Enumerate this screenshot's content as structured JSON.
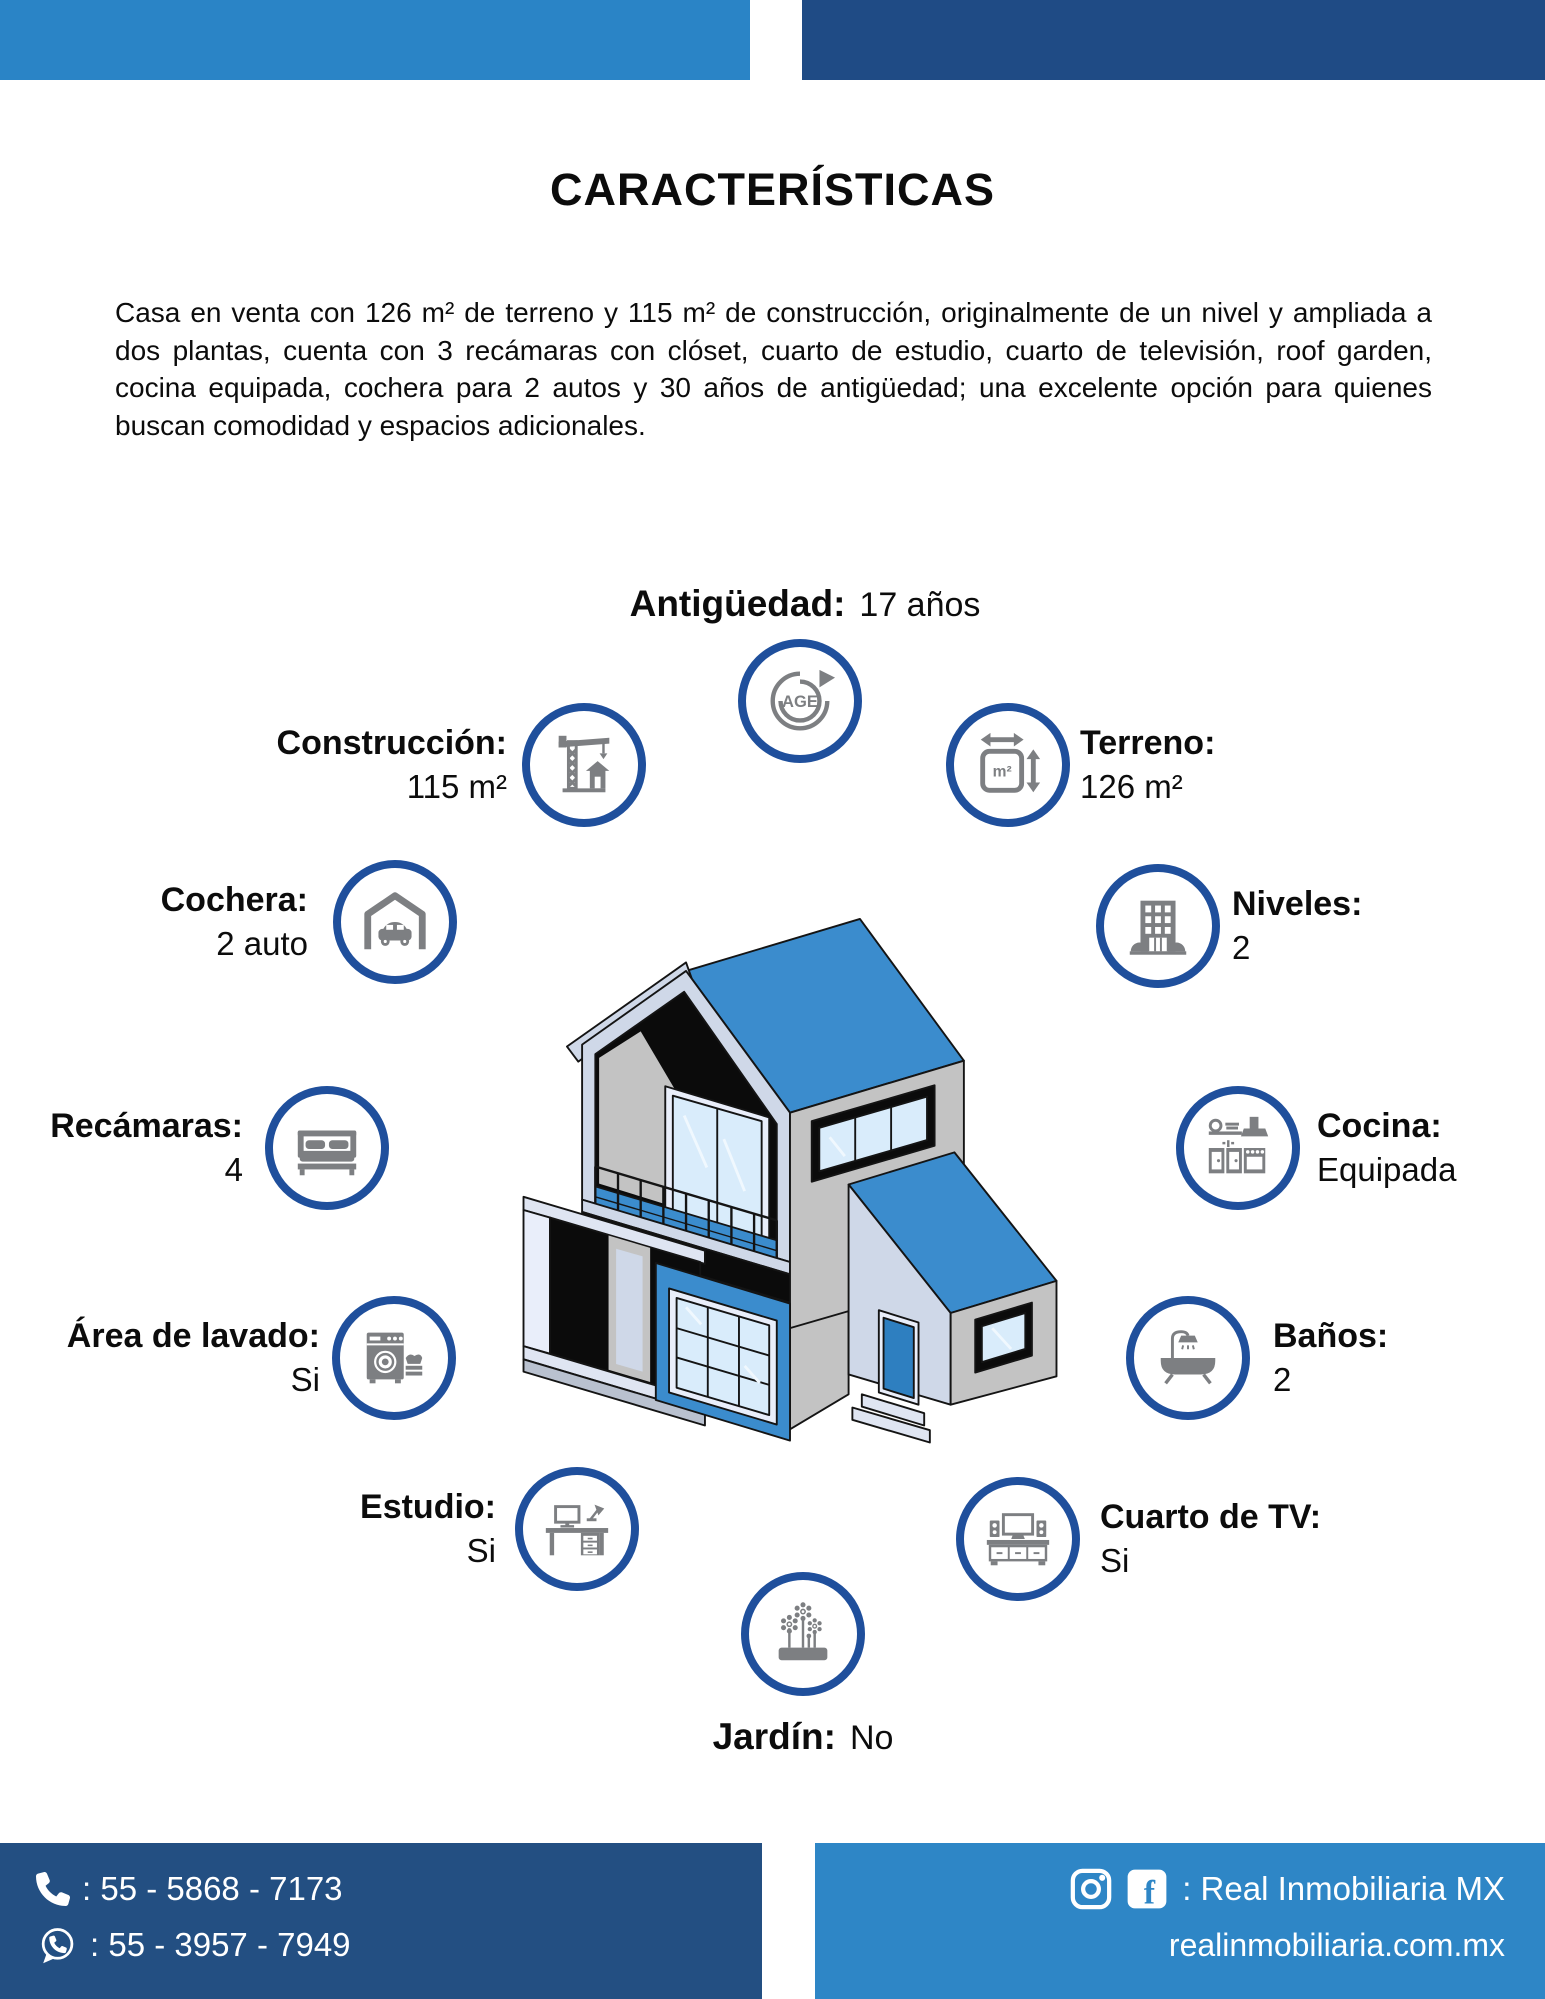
{
  "header": {
    "title": "CARACTERÍSTICAS"
  },
  "intro": {
    "text": "Casa en venta con 126 m² de terreno y 115 m² de construcción, originalmente de un nivel y ampliada a dos plantas, cuenta con 3 recámaras con clóset, cuarto de estudio, cuarto de televisión, roof garden, cocina equipada, cochera para 2 autos y 30 años de antigüedad; una excelente opción para quienes buscan comodidad y espacios adicionales."
  },
  "features": {
    "antiguedad": {
      "label": "Antigüedad:",
      "value": "17 años",
      "icon": "age-cycle-icon"
    },
    "construccion": {
      "label": "Construcción:",
      "value": "115 m²",
      "icon": "crane-icon"
    },
    "terreno": {
      "label": "Terreno:",
      "value": "126 m²",
      "icon": "area-m2-icon"
    },
    "cochera": {
      "label": "Cochera:",
      "value": "2 auto",
      "icon": "garage-car-icon"
    },
    "niveles": {
      "label": "Niveles:",
      "value": "2",
      "icon": "building-icon"
    },
    "recamaras": {
      "label": "Recámaras:",
      "value": "4",
      "icon": "bed-icon"
    },
    "cocina": {
      "label": "Cocina:",
      "value": "Equipada",
      "icon": "kitchen-icon"
    },
    "area_lavado": {
      "label": "Área de lavado:",
      "value": "Si",
      "icon": "laundry-icon"
    },
    "banos": {
      "label": "Baños:",
      "value": "2",
      "icon": "bathtub-icon"
    },
    "estudio": {
      "label": "Estudio:",
      "value": "Si",
      "icon": "desk-icon"
    },
    "cuarto_tv": {
      "label": "Cuarto de TV:",
      "value": "Si",
      "icon": "tv-room-icon"
    },
    "jardin": {
      "label": "Jardín:",
      "value": "No",
      "icon": "garden-icon"
    }
  },
  "footer": {
    "phone": ": 55 - 5868 - 7173",
    "whatsapp": ": 55 - 3957 - 7949",
    "social_handle": ": Real Inmobiliaria MX",
    "website": "realinmobiliaria.com.mx"
  },
  "colors": {
    "header_light_blue": "#2a84c6",
    "header_navy": "#1f4b85",
    "footer_navy": "#234f82",
    "footer_light_blue": "#2e86c6",
    "circle_ring_blue": "#1f4f9c",
    "icon_gray": "#7d7f82",
    "house_roof_blue": "#3b8ccd",
    "text_black": "#0c0c0c"
  }
}
